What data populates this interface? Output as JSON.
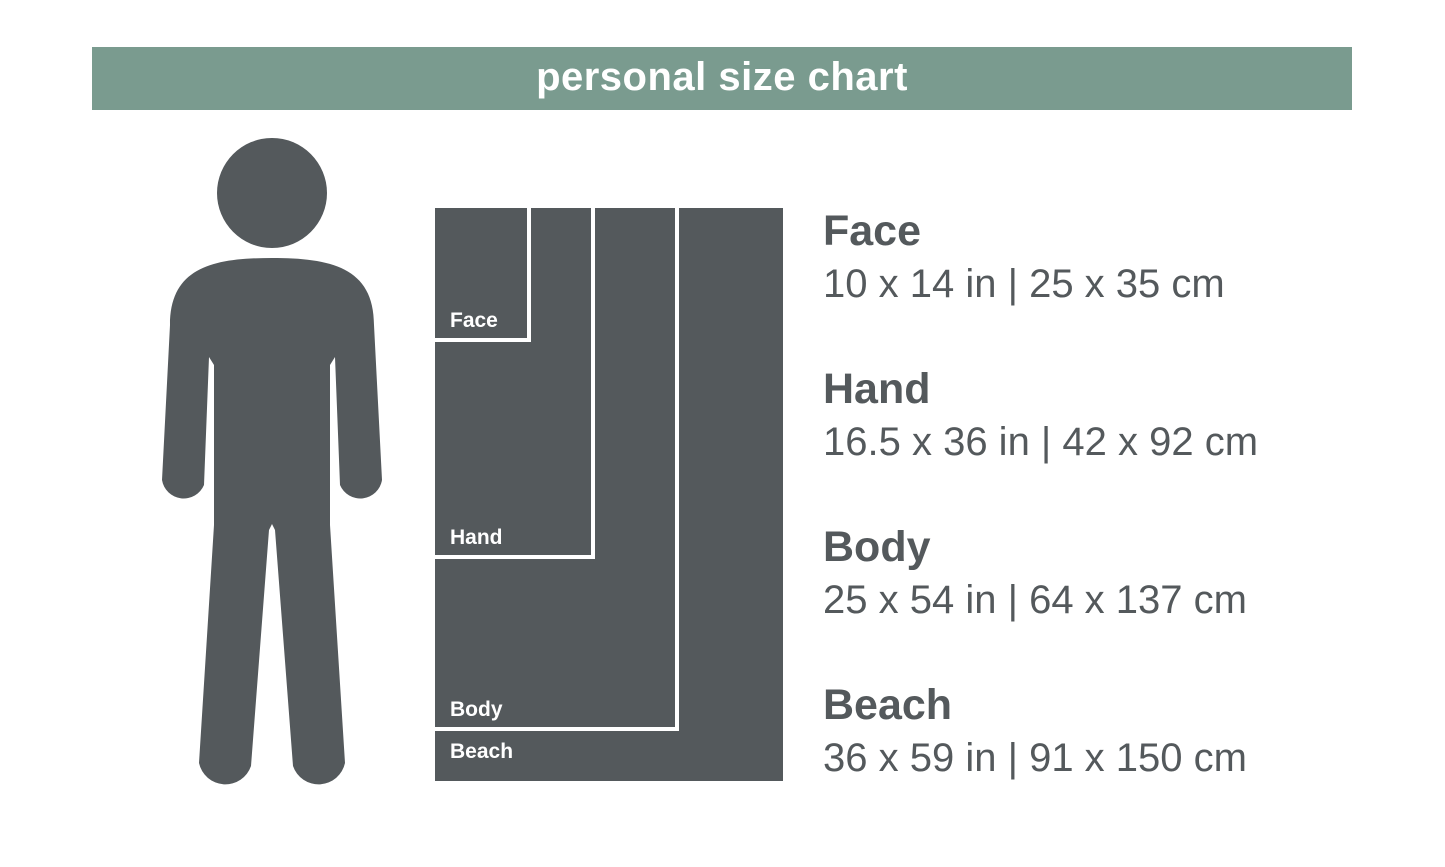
{
  "header": {
    "title": "personal size chart"
  },
  "colors": {
    "header_green": "#7a9b8f",
    "figure_gray": "#54595c",
    "diagram_gray": "#54595c",
    "divider_white": "#ffffff",
    "text_gray": "#54595c",
    "background": "#ffffff"
  },
  "figure": {
    "icon": "person-silhouette"
  },
  "chart_data": {
    "type": "nested-rectangle-size-comparison",
    "title": "personal size chart",
    "separator": "|",
    "items": [
      {
        "name": "Face",
        "inches": "10 x 14 in",
        "centimeters": "25 x 35 cm",
        "width_in": 10,
        "height_in": 14,
        "width_cm": 25,
        "height_cm": 35
      },
      {
        "name": "Hand",
        "inches": "16.5 x 36 in",
        "centimeters": "42 x 92 cm",
        "width_in": 16.5,
        "height_in": 36,
        "width_cm": 42,
        "height_cm": 92
      },
      {
        "name": "Body",
        "inches": "25 x 54 in",
        "centimeters": "64 x 137 cm",
        "width_in": 25,
        "height_in": 54,
        "width_cm": 64,
        "height_cm": 137
      },
      {
        "name": "Beach",
        "inches": "36 x 59 in",
        "centimeters": "91 x 150 cm",
        "width_in": 36,
        "height_in": 59,
        "width_cm": 91,
        "height_cm": 150
      }
    ]
  }
}
